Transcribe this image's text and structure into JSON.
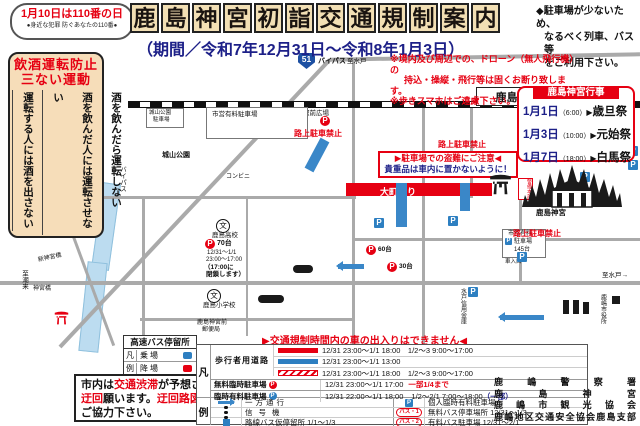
{
  "badge": {
    "line1": "1月10日は110番の日",
    "line2": "●身近な犯罪 防ぐあなたの110番●"
  },
  "title": {
    "c0": "鹿",
    "c1": "島",
    "c2": "神",
    "c3": "宮",
    "c4": "初",
    "c5": "詣",
    "c6": "交",
    "c7": "通",
    "c8": "規",
    "c9": "制",
    "c10": "案",
    "c11": "内",
    "subtitle": "（期間／令和7年12月31日～令和8年1月3日）"
  },
  "right_note": {
    "l1": "◆駐車場が少ないため、",
    "l2": "なるべく列車、バス等",
    "l3": "をご利用下さい。"
  },
  "drone_note": {
    "l1": "※境内及び周辺での、ドローン（無人飛行機）の",
    "l2": "持込・操縦・飛行等は固くお断り致します。",
    "l3": "※歩きスマホはご遠慮下さい。"
  },
  "sanai": {
    "title1": "飲酒運転防止",
    "title2": "三ない運動",
    "col1": "酒を飲んだら運転しない",
    "col2": "酒を飲んだ人には運転させない",
    "col3": "運転する人には酒を出さない"
  },
  "events": {
    "title": "鹿島神宮行事",
    "arrow": "▶",
    "items": [
      {
        "date": "1月1日",
        "time": "（6:00）",
        "name": "歳旦祭"
      },
      {
        "date": "1月3日",
        "time": "（10:00）",
        "name": "元始祭"
      },
      {
        "date": "1月7日",
        "time": "（18:00）",
        "name": "白馬祭"
      }
    ]
  },
  "map": {
    "p": "P",
    "school": "文",
    "station": "鹿島神宮駅",
    "plaza": "駅前広場",
    "route": "51",
    "bypass": "バイパス",
    "to_mito": "至水戸",
    "to_mito_arrow": "至水戸→",
    "to_itako": "至潮来",
    "omachi": "大町通り",
    "city_parking": "市営有料駐車場",
    "shiroyama_park": "城山公園",
    "shiroyama_pkg1": "城山公園",
    "shiroyama_pkg2": "駐車場",
    "hs": "鹿島高校",
    "hs_cap": "70台",
    "hs_d1": "12/31～1/1",
    "hs_d2": "23:00～17:00",
    "hs_close1": "（17:00に",
    "hs_close2": "閉鎖します）",
    "es": "鹿島小学校",
    "post1": "鹿島神宮前",
    "post2": "郵便局",
    "conv": "コンビニ",
    "bank": "水戸信用金庫",
    "cityhall": "鹿嶋市役所",
    "cp2a": "市営有料",
    "cp2b": "駐車場",
    "cp2c": "145台",
    "entrance": "車入口",
    "br1": "新神宮橋",
    "br2": "神宮橋",
    "security": "警備本部",
    "no_parking": "路上駐車禁止",
    "caution1": "▶駐車場での盗難にご注意◀",
    "caution2": "貴重品は車内に置かないように！",
    "shrine": "鹿島神宮",
    "cap60": "60台",
    "cap30": "30台"
  },
  "express_bus": {
    "title": "高速バス停留所",
    "row1_key": "凡",
    "row1_label": "乗場",
    "row2_key": "例",
    "row2_label": "降場"
  },
  "notice": {
    "seg1": "市内は",
    "seg2": "交通渋滞",
    "seg3": "が予想されますので",
    "seg4": "迂回",
    "seg5": "願います。",
    "seg6": "迂回路図",
    "seg7": "は裏面です。",
    "seg8": "ご協力下さい。"
  },
  "legend": {
    "warning": "▶交通規制時間内の車の出入りはできません◀",
    "han": "凡",
    "rei": "例",
    "pedestrian": "歩行者用道路",
    "ped1": "12/31 23:00～1/1 18:00　1/2～3 9:00～17:00",
    "ped2": "12/31 23:00～1/1 13:00",
    "ped3": "12/31 23:00～1/1 18:00　1/2～3 9:00～17:00",
    "free_label": "無料臨時駐車場",
    "free_time": "12/31 23:00～1/1 17:00",
    "free_extra": "一部1/4まで",
    "paid_label": "臨時有料駐車場",
    "paid_time": "12/31 22:00～1/1 18:00",
    "paid_time2": "1/2～2/1 7:00～18:00",
    "paid_extra": "（一部）",
    "oneway": "一方通行",
    "signal": "信号機",
    "busstop": "路線バス仮停留所 1/1～1/3",
    "p_private": "個人臨時有料駐車場",
    "bus1_icon": "バス・1",
    "bus1_label": "無料バス停車場所 12/31～1/3",
    "bus2_icon": "バス・2",
    "bus2_label": "有料バス駐車場 12/31～2/1"
  },
  "orgs": {
    "o1": "鹿嶋警察署",
    "o2": "鹿島神宮",
    "o3": "鹿嶋市観光協会",
    "o4": "鹿嶋地区交通安全協会鹿島支部"
  },
  "colors": {
    "accent_red": "#e60012",
    "accent_blue": "#1d2088",
    "road_blue": "#3a87c8",
    "title_tan": "#f2dfb4",
    "river": "#bcdcf0"
  }
}
